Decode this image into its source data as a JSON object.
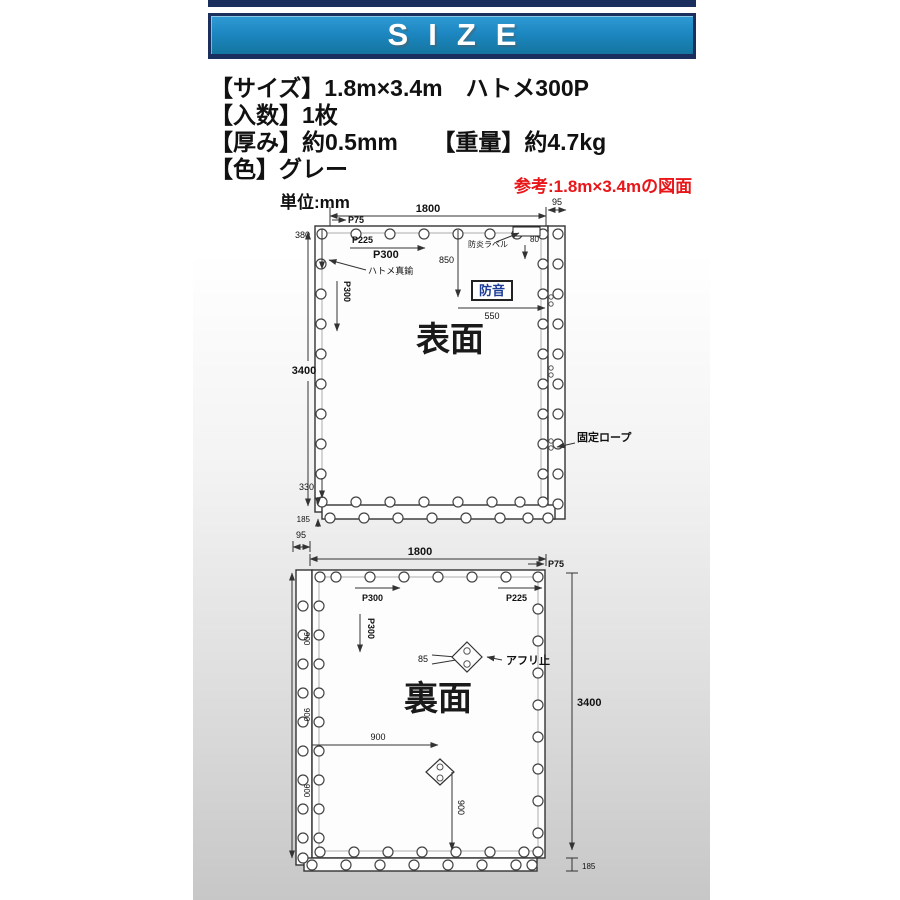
{
  "banner": {
    "title": "SIZE"
  },
  "specs": {
    "size": "【サイズ】1.8m×3.4m　ハトメ300P",
    "quantity": "【入数】1枚",
    "thickness": "【厚み】約0.5mm　　【重量】約4.7kg",
    "color": "【色】グレー"
  },
  "reference_note": "参考:1.8m×3.4mの図面",
  "unit_label": "単位:mm",
  "front": {
    "title": "表面",
    "dims": {
      "width": "1800",
      "hem": "95",
      "top_offset": "380",
      "height": "3400",
      "bottom_offset": "330",
      "hem_bottom": "185",
      "label_drop": "850",
      "label_offset": "80",
      "label_width": "550"
    },
    "pitch": {
      "p75": "P75",
      "p225": "P225",
      "p300": "P300",
      "p300v": "P300"
    },
    "labels": {
      "grommet": "ハトメ真鍮",
      "flame": "防炎ラベル",
      "soundproof": "防音",
      "rope": "固定ロープ"
    }
  },
  "back": {
    "title": "裏面",
    "dims": {
      "hem": "95",
      "width": "1800",
      "height": "3400",
      "hem_bottom": "185",
      "h900": "900",
      "v900": "900",
      "d85": "85",
      "left_segments": [
        "900",
        "900",
        "900"
      ]
    },
    "pitch": {
      "p75": "P75",
      "p300": "P300",
      "p225": "P225",
      "p300v": "P300"
    },
    "labels": {
      "stopper": "アフリ止"
    }
  }
}
